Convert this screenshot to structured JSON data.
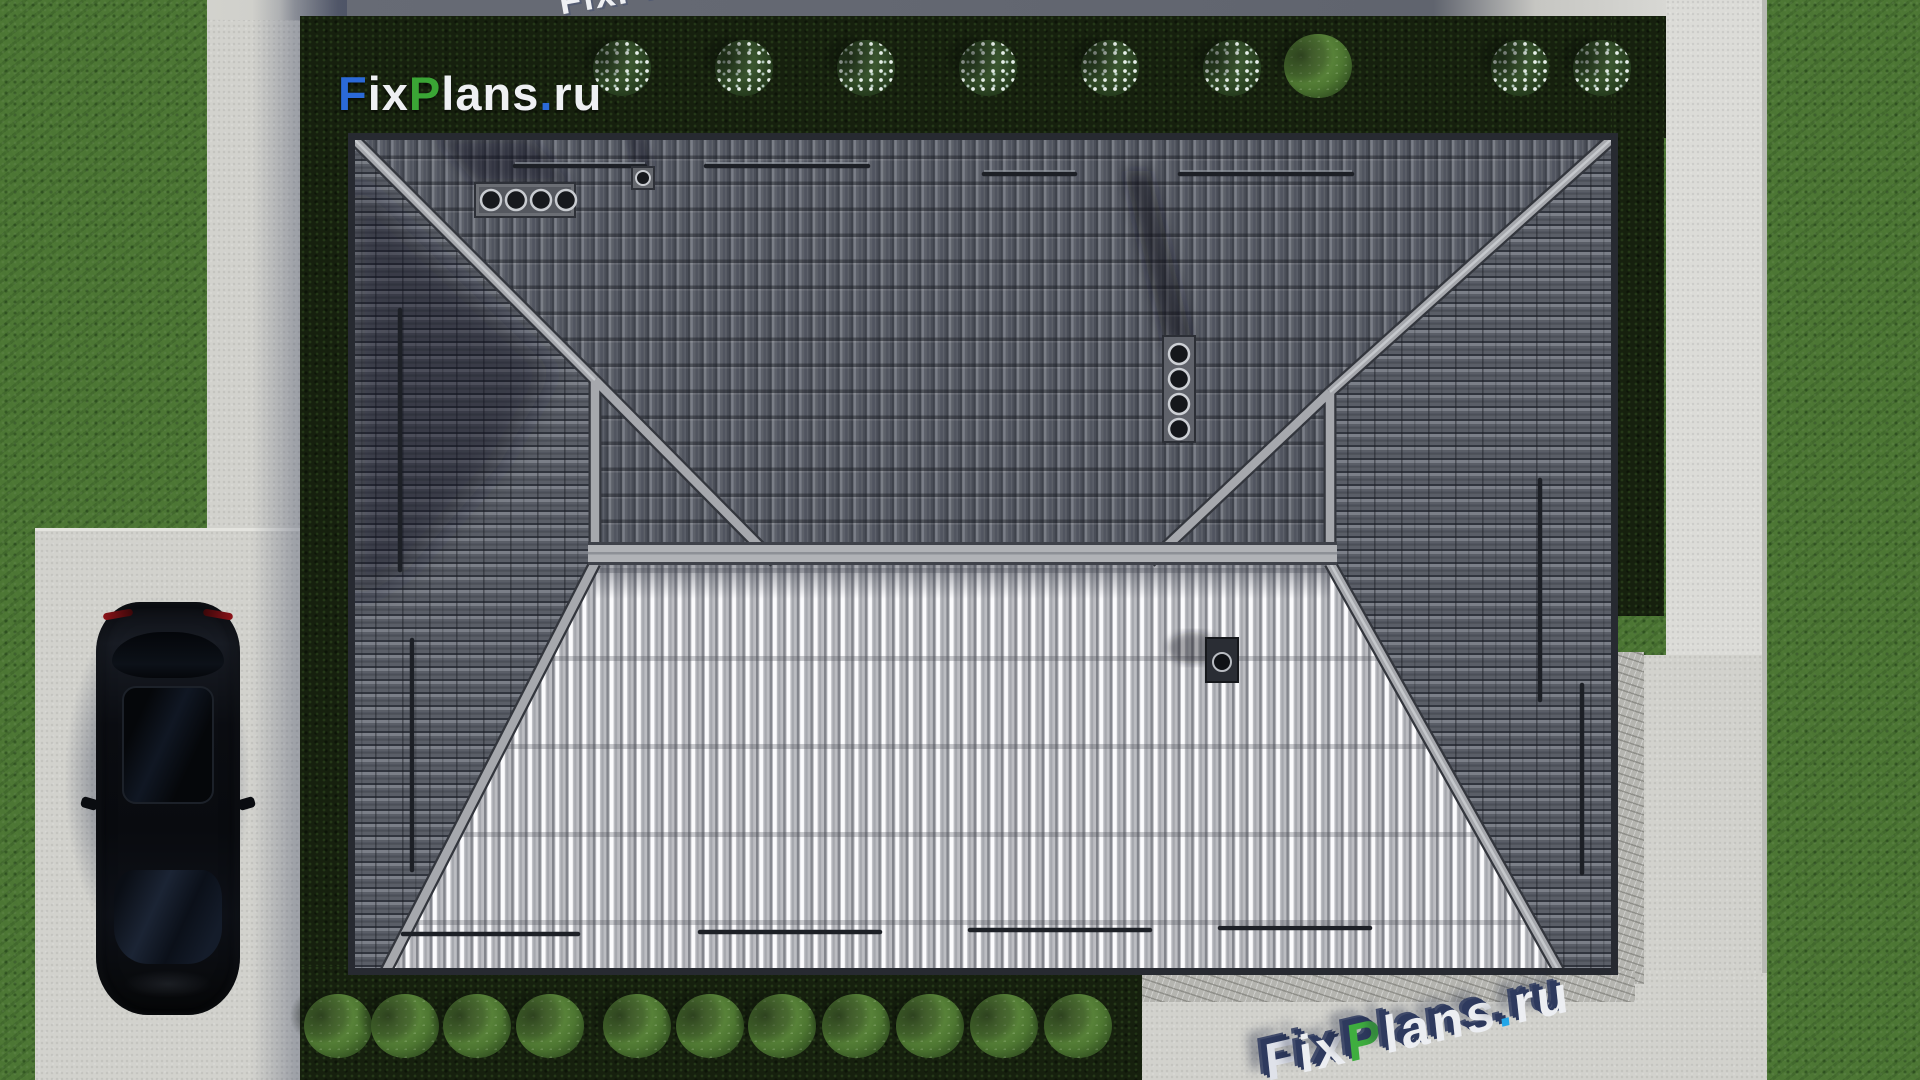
{
  "page": {
    "title": "FixPlans.ru — план кровли дома (вид сверху)"
  },
  "logo": {
    "text": "FixPlans.ru",
    "position": "top-left",
    "segments": [
      {
        "t": "F",
        "c": "#2b6ad8"
      },
      {
        "t": "ix",
        "c": "#eef0f3"
      },
      {
        "t": "P",
        "c": "#3aa535"
      },
      {
        "t": "lans",
        "c": "#eef0f3"
      },
      {
        "t": ".",
        "c": "#2b6ad8"
      },
      {
        "t": "ru",
        "c": "#eef0f3"
      }
    ]
  },
  "watermark_top": {
    "text": "FixPlans.ru",
    "segments": [
      {
        "t": "FixPlans",
        "c": "#eef0f3"
      },
      {
        "t": ".",
        "c": "#28a3e8"
      },
      {
        "t": "ru",
        "c": "#eef0f3"
      }
    ]
  },
  "watermark_bottom": {
    "text": "FixPlans.ru",
    "segments": [
      {
        "t": "F",
        "c": "#dfe2ea"
      },
      {
        "t": "ix",
        "c": "#eceef2"
      },
      {
        "t": "P",
        "c": "#3fae3f"
      },
      {
        "t": "lans",
        "c": "#eceef2"
      },
      {
        "t": ".",
        "c": "#23a7e9"
      },
      {
        "t": "ru",
        "c": "#eceef2"
      }
    ]
  },
  "colors": {
    "grass": "#4c7634",
    "hedge": "#16200e",
    "concrete_light": "#d4d4cf",
    "concrete_shadow": "#6a6e78",
    "roof_dark_tile": "#5d616a",
    "roof_bright_tile": "#f2f2f5",
    "ridge_cap": "#a8abb0",
    "car_body": "#0b0d12"
  },
  "scene": {
    "description": "Top-down 3D render of a hip-roof house: dark tiled north/east/west slopes, bright metal south slope, roof vents and chimneys, hedges with bushes, lawn, concrete paths, driveway with a black car",
    "bushes_top_white": [
      622,
      744,
      866,
      988,
      1110,
      1232,
      1520,
      1602
    ],
    "bushes_top_green": [
      1318
    ],
    "bushes_bottom": [
      338,
      405,
      477,
      550,
      637,
      710,
      782,
      856,
      930,
      1004,
      1078
    ]
  }
}
